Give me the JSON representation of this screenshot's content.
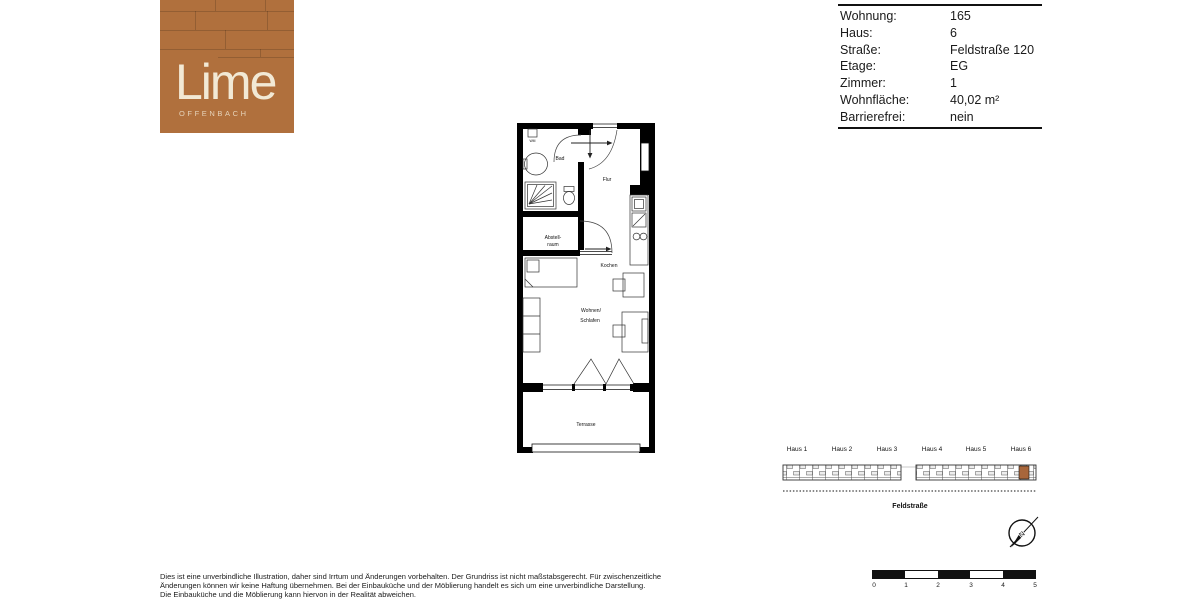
{
  "logo": {
    "brand": "Lime",
    "city": "OFFENBACH",
    "bg_color": "#b0703d",
    "text_color": "#f2e9d5"
  },
  "info": {
    "rows": [
      {
        "label": "Wohnung:",
        "value": "165"
      },
      {
        "label": "Haus:",
        "value": "6"
      },
      {
        "label": "Straße:",
        "value": "Feldstraße 120"
      },
      {
        "label": "Etage:",
        "value": "EG"
      },
      {
        "label": "Zimmer:",
        "value": "1"
      },
      {
        "label": "Wohnfläche:",
        "value": "40,02 m²"
      },
      {
        "label": "Barrierefrei:",
        "value": "nein"
      }
    ]
  },
  "floorplan": {
    "labels": {
      "wm": "WM",
      "bad": "Bad",
      "flur": "Flur",
      "abstell1": "Abstell-",
      "abstell2": "raum",
      "kochen": "Kochen",
      "wohnen1": "Wohnen/",
      "wohnen2": "Schlafen",
      "terrasse": "Terrasse"
    }
  },
  "siteplan": {
    "houses": [
      "Haus 1",
      "Haus 2",
      "Haus 3",
      "Haus 4",
      "Haus 5",
      "Haus 6"
    ],
    "street": "Feldstraße",
    "highlighted_house": "Haus 6",
    "highlight_color": "#a8663b"
  },
  "compass": {
    "north_label": "N"
  },
  "scalebar": {
    "ticks": [
      "0",
      "1",
      "2",
      "3",
      "4",
      "5"
    ]
  },
  "disclaimer": {
    "line1": "Dies ist eine unverbindliche Illustration, daher sind Irrtum und Änderungen vorbehalten. Der Grundriss ist nicht maßstabsgerecht. Für zwischenzeitliche",
    "line2": "Änderungen können wir keine Haftung übernehmen. Bei der Einbauküche und der Möblierung handelt es sich um eine unverbindliche Darstellung.",
    "line3": "Die Einbauküche und die Möblierung kann hiervon in der Realität abweichen."
  }
}
